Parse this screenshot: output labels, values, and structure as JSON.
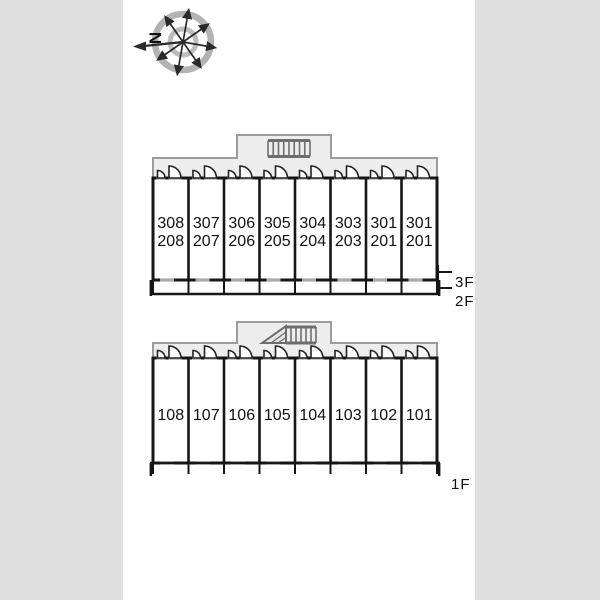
{
  "compass": {
    "north_label": "N"
  },
  "upper_building": {
    "rooms": [
      {
        "floor3": "308",
        "floor2": "208"
      },
      {
        "floor3": "307",
        "floor2": "207"
      },
      {
        "floor3": "306",
        "floor2": "206"
      },
      {
        "floor3": "305",
        "floor2": "205"
      },
      {
        "floor3": "304",
        "floor2": "204"
      },
      {
        "floor3": "303",
        "floor2": "203"
      },
      {
        "floor3": "301",
        "floor2": "201"
      },
      {
        "floor3": "301",
        "floor2": "201"
      }
    ],
    "floor_labels": {
      "f3": "3F",
      "f2": "2F"
    }
  },
  "lower_building": {
    "rooms": [
      "108",
      "107",
      "106",
      "105",
      "104",
      "103",
      "102",
      "101"
    ],
    "floor_label": "1F"
  },
  "colors": {
    "background": "#dfdfdf",
    "sheet": "#ffffff",
    "wall": "#161616",
    "corridor_fill": "#ededed",
    "corridor_stroke": "#9c9c9c",
    "stair_gray": "#6e6e6e",
    "window_gray": "#a8a8a8",
    "compass_ring_gray": "#b3b3b3"
  }
}
